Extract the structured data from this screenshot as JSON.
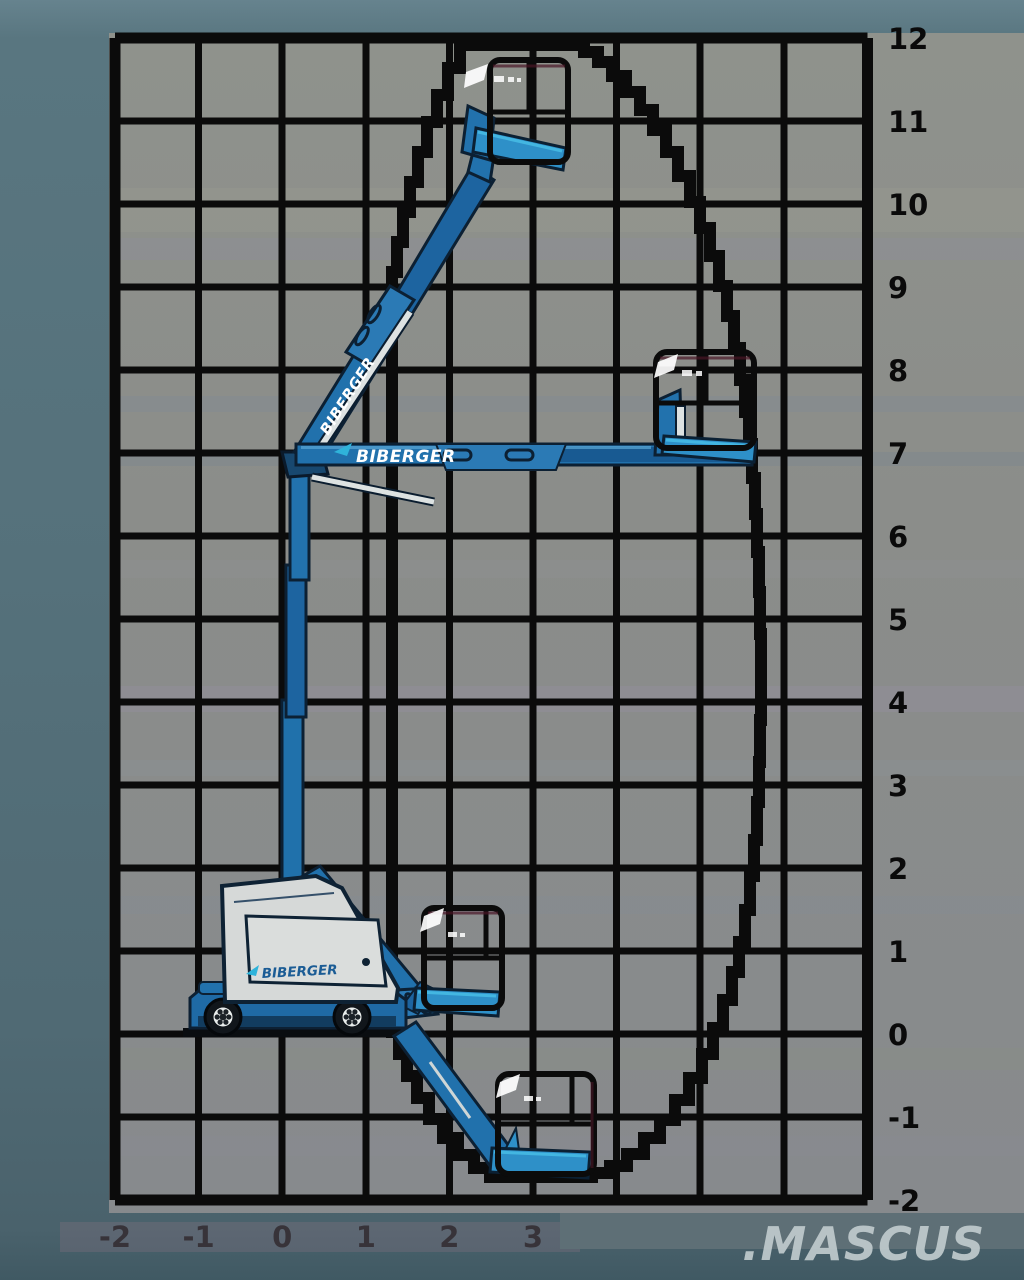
{
  "brand": "BIBERGER",
  "watermark": ".MASCUS",
  "axes": {
    "right_labels": [
      "12",
      "11",
      "10",
      "9",
      "8",
      "7",
      "6",
      "5",
      "4",
      "3",
      "2",
      "1",
      "0",
      "-1",
      "-2"
    ],
    "bottom_labels": [
      "-2",
      "-1",
      "0",
      "1",
      "2",
      "3",
      "4",
      "5",
      "6",
      "7"
    ]
  },
  "colors": {
    "grid_black": "#0b0b0b",
    "plot_gray": "#8c8e8b",
    "margin_teal": "#54707a",
    "machine_blue": "#2171ac",
    "machine_navy": "#0c2033",
    "turret_gray": "#d6d9d8",
    "accent_cyan": "#35b6e0",
    "basket_floor_blue": "#2e90c8",
    "logo_blue": "#1b5c95",
    "watermark_gray": "#c0cbcd"
  }
}
